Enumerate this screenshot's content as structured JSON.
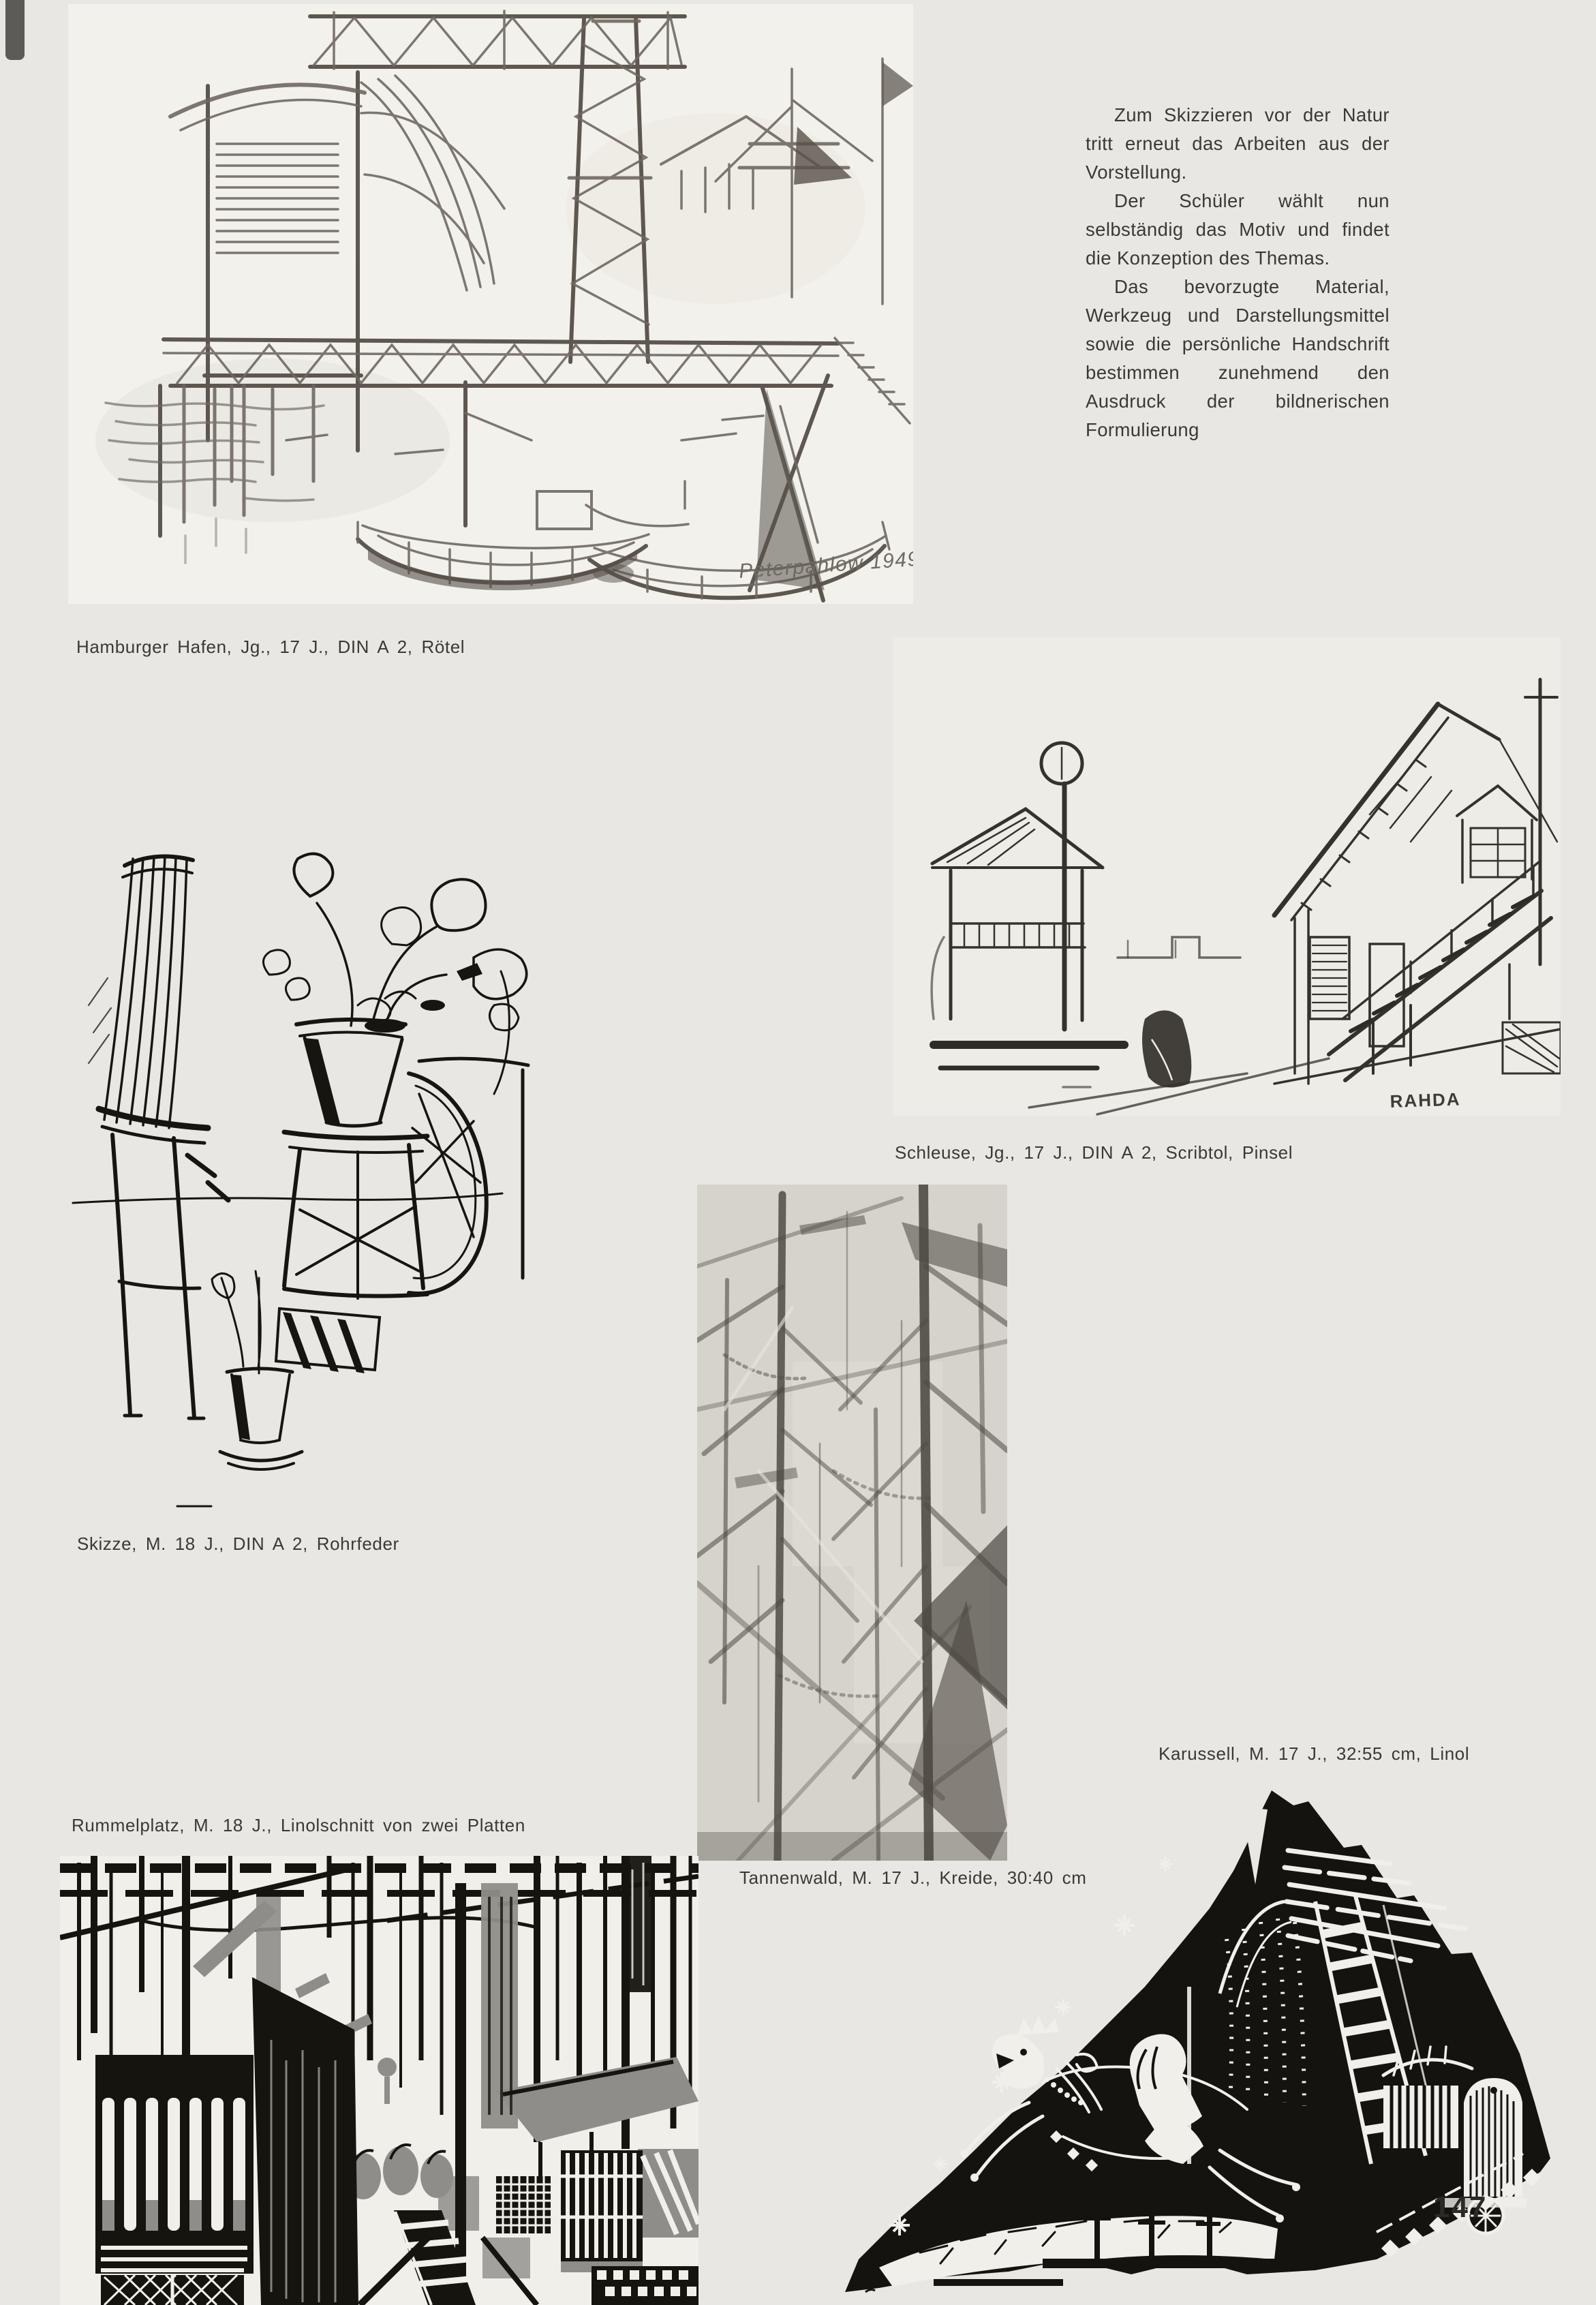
{
  "page": {
    "number": "147",
    "background_color": "#e8e7e3",
    "paper_color": "#f2f1ec",
    "ink_color": "#3b3935",
    "linocut_gray": "#8e8d89"
  },
  "intro": {
    "paragraphs": [
      "Zum Skizzieren vor der Natur tritt erneut das Arbeiten aus der Vorstellung.",
      "Der Schüler wählt nun selbständig das Motiv und findet die Konzeption des Themas.",
      "Das bevorzugte Material, Werkzeug und Darstellungsmittel sowie die persönliche Handschrift bestimmen zunehmend den Ausdruck der bildnerischen Formulierung"
    ]
  },
  "artworks": {
    "hamburger_hafen": {
      "caption": "Hamburger Hafen, Jg., 17 J., DIN A 2, Rötel",
      "signature": "Peterpahlow 1949",
      "description": "chalk sketch of harbour with cranes, truss bridge and boats"
    },
    "schleuse": {
      "caption": "Schleuse, Jg., 17 J., DIN A 2, Scribtol, Pinsel",
      "signature": "RAHDA",
      "description": "brush and ink sketch of gabled lock house with outer staircase and lamp post"
    },
    "skizze": {
      "caption": "Skizze, M. 18 J., DIN A 2, Rohrfeder",
      "description": "reed pen ink sketch of potted plants on chair and stools"
    },
    "karussell": {
      "caption": "Karussell, M. 17 J., 32:55 cm, Linol",
      "description": "linocut carousel horse with rider inside dark triangular night shape with stars"
    },
    "rummelplatz": {
      "caption": "Rummelplatz, M. 18 J., Linolschnitt von zwei Platten",
      "description": "two plate linocut of fairground booths, ladder and striped stalls"
    },
    "tannenwald": {
      "caption": "Tannenwald, M. 17 J., Kreide, 30:40 cm",
      "description": "chalk drawing of fir trunks with crossing diagonal branches"
    }
  }
}
